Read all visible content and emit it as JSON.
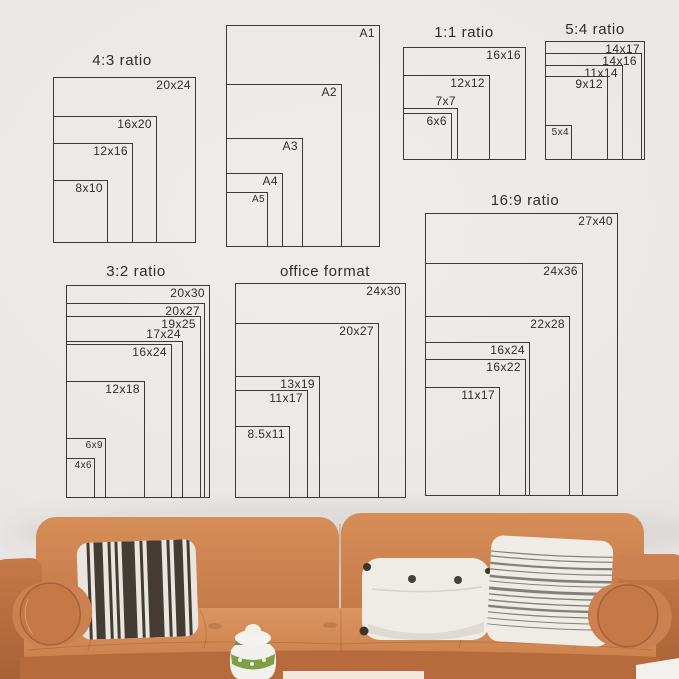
{
  "palette": {
    "wall": "#eae8e6",
    "line": "#3b3b3b",
    "text": "#2e2e2e",
    "leather": "#c87c4c",
    "leather_light": "#d9935f",
    "leather_dark": "#a96034",
    "pillow_white": "#efece6",
    "pillow_stripe_dark": "#453c35",
    "pillow_gray_stripe": "#81807a",
    "plant_green": "#7da043",
    "table_cream": "#efe8da"
  },
  "size_guide": {
    "groups": [
      {
        "id": "4-3",
        "title": "4:3 ratio",
        "title_cx": 122,
        "title_top": 52,
        "left": 53,
        "bottom": 243,
        "sizes": [
          {
            "label": "20x24",
            "w": 143,
            "h": 166
          },
          {
            "label": "16x20",
            "w": 104,
            "h": 127
          },
          {
            "label": "12x16",
            "w": 80,
            "h": 100
          },
          {
            "label": "8x10",
            "w": 55,
            "h": 63
          }
        ]
      },
      {
        "id": "a-series",
        "title": "",
        "title_cx": 0,
        "title_top": 0,
        "left": 226,
        "bottom": 247,
        "sizes": [
          {
            "label": "A1",
            "w": 154,
            "h": 222
          },
          {
            "label": "A2",
            "w": 116,
            "h": 163
          },
          {
            "label": "A3",
            "w": 77,
            "h": 109
          },
          {
            "label": "A4",
            "w": 57,
            "h": 74
          },
          {
            "label": "A5",
            "w": 42,
            "h": 55
          }
        ]
      },
      {
        "id": "1-1",
        "title": "1:1 ratio",
        "title_cx": 464,
        "title_top": 24,
        "left": 403,
        "bottom": 160,
        "sizes": [
          {
            "label": "16x16",
            "w": 123,
            "h": 113
          },
          {
            "label": "12x12",
            "w": 87,
            "h": 85
          },
          {
            "label": "7x7",
            "w": 55,
            "h": 52,
            "label_pos": "above"
          },
          {
            "label": "6x6",
            "w": 49,
            "h": 47
          }
        ]
      },
      {
        "id": "5-4",
        "title": "5:4 ratio",
        "title_cx": 595,
        "title_top": 21,
        "left": 545,
        "bottom": 160,
        "sizes": [
          {
            "label": "14x17",
            "w": 100,
            "h": 119
          },
          {
            "label": "14x16",
            "w": 97,
            "h": 107
          },
          {
            "label": "11x14",
            "w": 78,
            "h": 95
          },
          {
            "label": "9x12",
            "w": 63,
            "h": 84
          },
          {
            "label": "5x4",
            "w": 27,
            "h": 35
          }
        ]
      },
      {
        "id": "3-2",
        "title": "3:2 ratio",
        "title_cx": 136,
        "title_top": 263,
        "left": 66,
        "bottom": 498,
        "sizes": [
          {
            "label": "20x30",
            "w": 144,
            "h": 213
          },
          {
            "label": "20x27",
            "w": 139,
            "h": 195
          },
          {
            "label": "19x25",
            "w": 135,
            "h": 182
          },
          {
            "label": "17x24",
            "w": 117,
            "h": 157,
            "label_pos": "above"
          },
          {
            "label": "16x24",
            "w": 106,
            "h": 154
          },
          {
            "label": "12x18",
            "w": 79,
            "h": 117
          },
          {
            "label": "6x9",
            "w": 40,
            "h": 60
          },
          {
            "label": "4x6",
            "w": 29,
            "h": 40
          }
        ]
      },
      {
        "id": "office",
        "title": "office format",
        "title_cx": 325,
        "title_top": 263,
        "left": 235,
        "bottom": 498,
        "sizes": [
          {
            "label": "24x30",
            "w": 171,
            "h": 215
          },
          {
            "label": "20x27",
            "w": 144,
            "h": 175
          },
          {
            "label": "13x19",
            "w": 85,
            "h": 122
          },
          {
            "label": "11x17",
            "w": 73,
            "h": 108
          },
          {
            "label": "8.5x11",
            "w": 55,
            "h": 72
          }
        ]
      },
      {
        "id": "16-9",
        "title": "16:9 ratio",
        "title_cx": 525,
        "title_top": 192,
        "left": 425,
        "bottom": 496,
        "sizes": [
          {
            "label": "27x40",
            "w": 193,
            "h": 283
          },
          {
            "label": "24x36",
            "w": 158,
            "h": 233
          },
          {
            "label": "22x28",
            "w": 145,
            "h": 180
          },
          {
            "label": "16x24",
            "w": 105,
            "h": 154
          },
          {
            "label": "16x22",
            "w": 101,
            "h": 137
          },
          {
            "label": "11x17",
            "w": 75,
            "h": 109
          }
        ]
      }
    ]
  },
  "sofa": {
    "pillows": [
      "black-white-striped",
      "white-lumbar-with-buttons",
      "gray-striped"
    ],
    "accessories": [
      "green-white-vase"
    ]
  }
}
